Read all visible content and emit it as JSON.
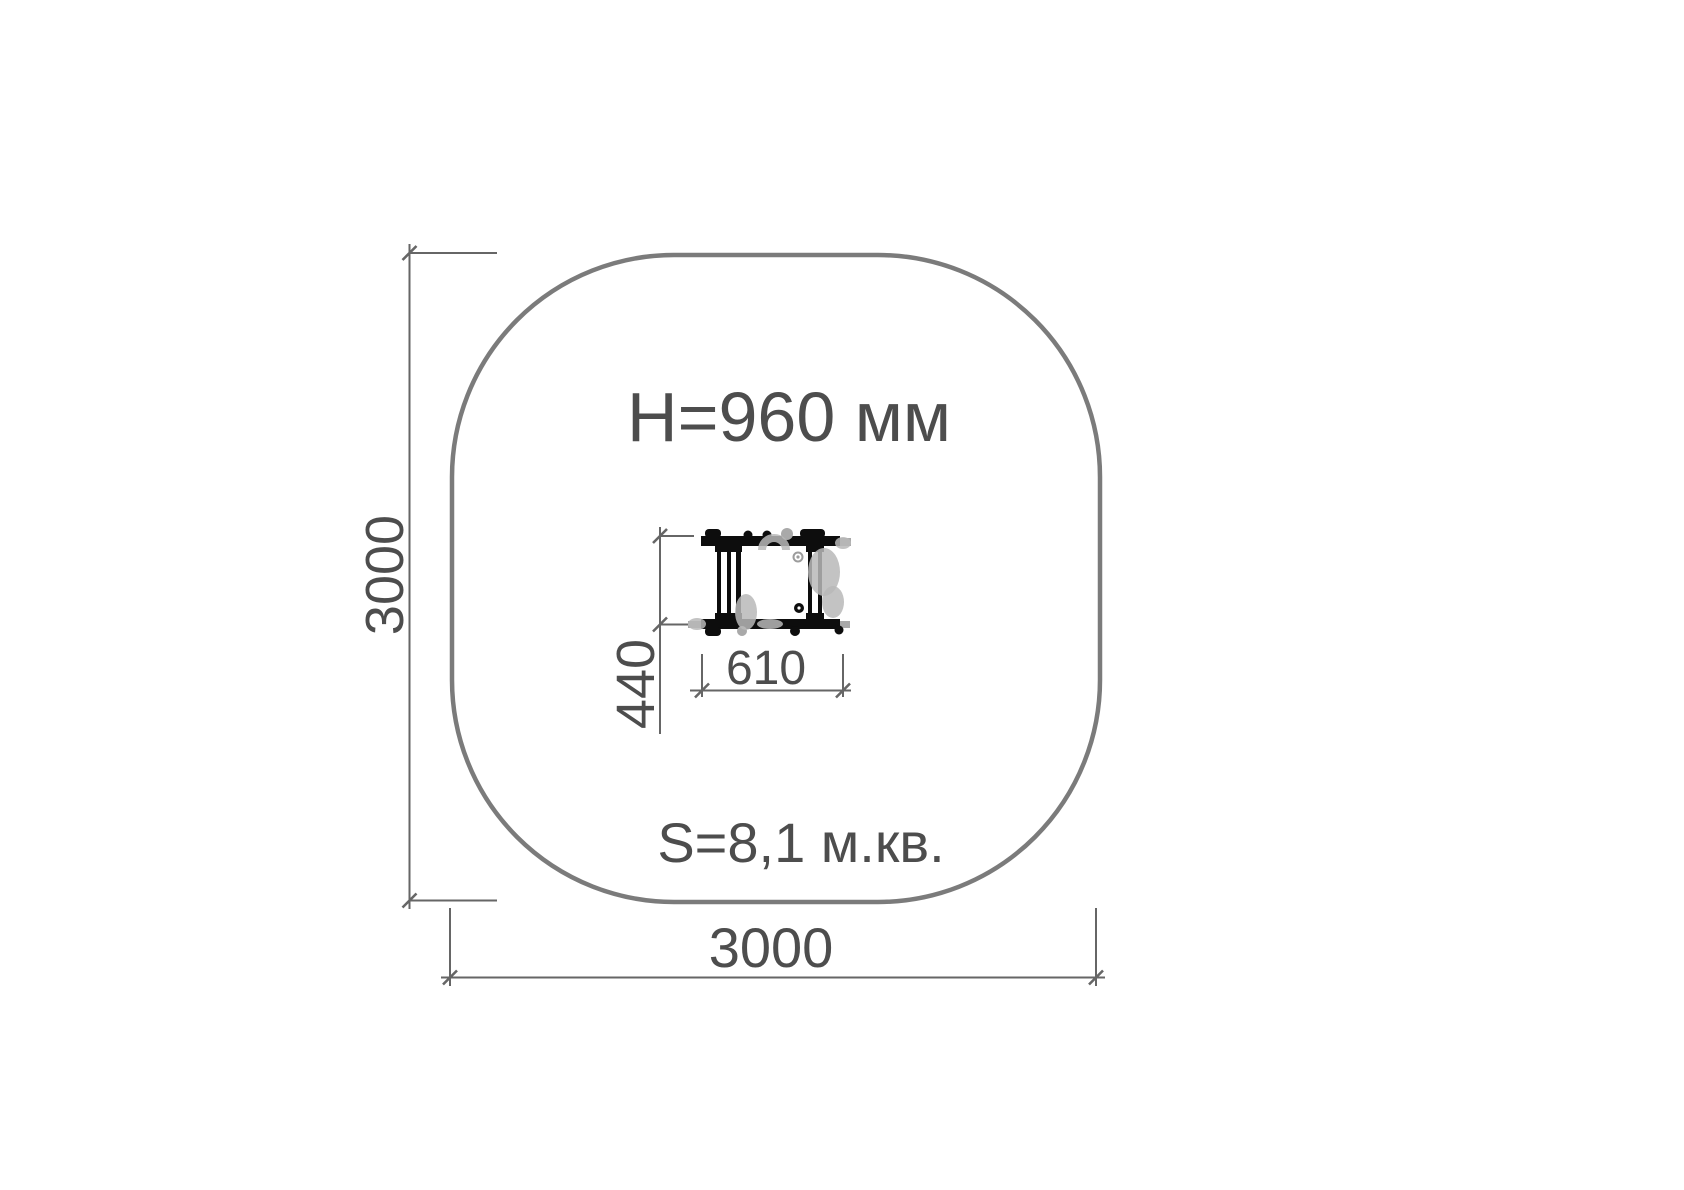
{
  "plan": {
    "equipment_height_label": "H=960 мм",
    "area_label": "S=8,1 м.кв."
  },
  "dimensions": {
    "overall_width": "3000",
    "overall_height": "3000",
    "equipment_width": "610",
    "equipment_depth": "440"
  },
  "colors": {
    "outline": "#7b7b7b",
    "dim-line": "#666666",
    "text-color": "#4d4d4d",
    "equipment": "#0d0d0d",
    "watermark": "#b9b9b9",
    "bolt-gray": "#9c9c9c",
    "end-cap": "#a9a9a9"
  }
}
